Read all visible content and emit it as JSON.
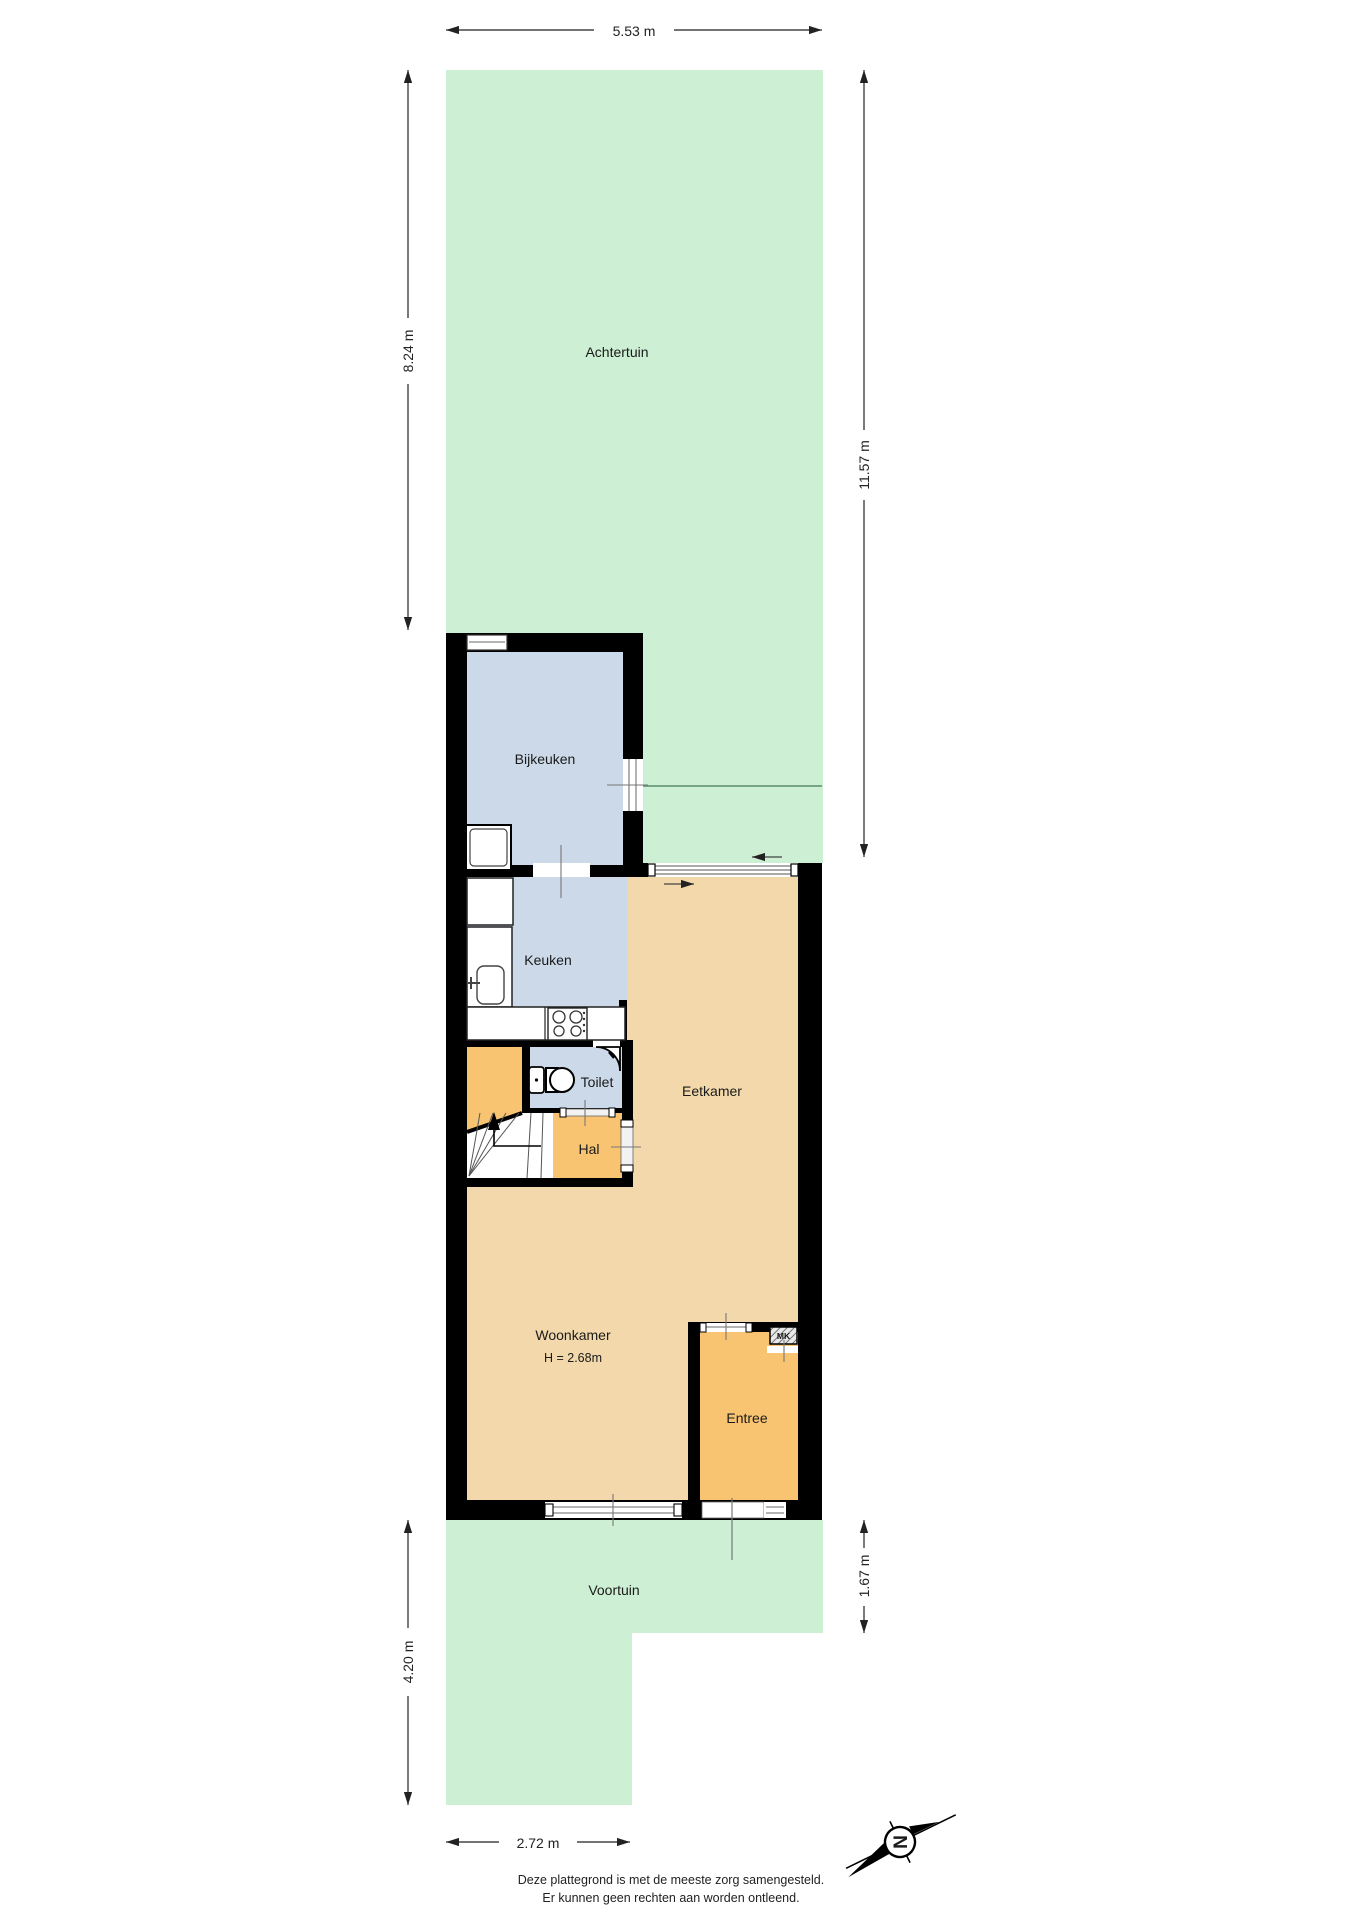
{
  "plan": {
    "rooms": {
      "achtertuin": "Achtertuin",
      "bijkeuken": "Bijkeuken",
      "keuken": "Keuken",
      "toilet": "Toilet",
      "hal": "Hal",
      "eetkamer": "Eetkamer",
      "woonkamer": "Woonkamer",
      "woonkamer_height": "H = 2.68m",
      "entree": "Entree",
      "voortuin": "Voortuin",
      "mk": "MK"
    },
    "dimensions": {
      "top_width": "5.53 m",
      "backgarden_depth": "8.24 m",
      "right_depth": "11.57 m",
      "frontgarden_depth_left": "4.20 m",
      "frontgarden_depth_right": "1.67 m",
      "bottom_width": "2.72 m"
    },
    "compass": {
      "north": "N"
    },
    "footer": {
      "line1": "Deze plattegrond is met de meeste zorg samengesteld.",
      "line2": "Er kunnen geen rechten aan worden ontleend."
    },
    "colors": {
      "garden": "#cdf0d4",
      "wet_rooms": "#ccd9e8",
      "living_rooms": "#f2d8aa",
      "circulation": "#f8c472",
      "walls": "#000000",
      "boundary_line": "#5a8c6e",
      "background": "#ffffff"
    }
  }
}
